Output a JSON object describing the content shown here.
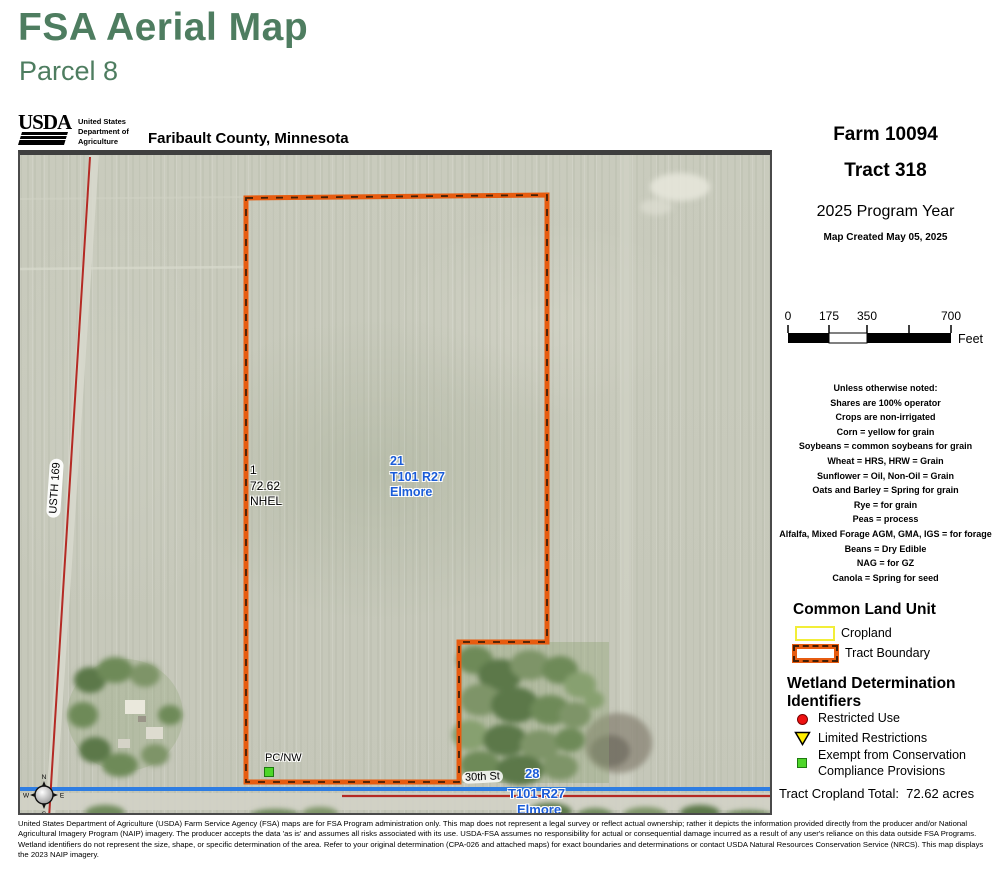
{
  "header": {
    "title": "FSA Aerial Map",
    "subtitle": "Parcel 8",
    "usda_wordmark": "USDA",
    "agency_line1": "United States",
    "agency_line2": "Department of",
    "agency_line3": "Agriculture",
    "county": "Faribault County, Minnesota"
  },
  "panel": {
    "farm": "Farm 10094",
    "tract": "Tract 318",
    "program_year": "2025 Program Year",
    "created": "Map Created May 05, 2025",
    "scale": {
      "t0": "0",
      "t175": "175",
      "t350": "350",
      "t700": "700",
      "unit": "Feet"
    },
    "notes": [
      "Unless otherwise noted:",
      "Shares are 100% operator",
      "Crops are non-irrigated",
      "Corn = yellow for grain",
      "Soybeans = common soybeans for grain",
      "Wheat = HRS, HRW = Grain",
      "Sunflower = Oil, Non-Oil = Grain",
      "Oats and Barley = Spring for grain",
      "Rye = for grain",
      "Peas = process",
      "Alfalfa, Mixed Forage AGM, GMA, IGS = for forage",
      "Beans = Dry Edible",
      "NAG = for GZ",
      "Canola = Spring for seed"
    ],
    "legend": {
      "clu_title": "Common Land Unit",
      "cropland": "Cropland",
      "tract_boundary": "Tract Boundary",
      "wetland_title_1": "Wetland Determination",
      "wetland_title_2": "Identifiers",
      "restricted": "Restricted Use",
      "limited": "Limited Restrictions",
      "exempt_1": "Exempt from Conservation",
      "exempt_2": "Compliance Provisions"
    },
    "tract_total": "Tract Cropland Total:  72.62 acres"
  },
  "map": {
    "labels": {
      "highway": "USTH 169",
      "field_number": "1",
      "field_acres": "72.62",
      "field_hel": "NHEL",
      "sec21_num": "21",
      "sec21_twp": "T101 R27",
      "sec21_name": "Elmore",
      "wetland_pcnw": "PC/NW",
      "street": "30th St",
      "sec28_num": "28",
      "sec28_twp": "T101 R27",
      "sec28_name": "Elmore"
    },
    "compass": {
      "n": "N",
      "e": "E",
      "s": "S",
      "w": "W"
    },
    "colors": {
      "tract_boundary": "#e75c10",
      "cropland_outline": "#f2ee38",
      "waterline_blue": "#2e7de2",
      "road_red": "#b42a24",
      "section_label_blue": "#1a5cd8",
      "marker_green": "#4ed629",
      "restricted_red": "#ee1111",
      "limited_yellow": "#ffee00"
    }
  },
  "footer": {
    "disclaimer": "United States Department of Agriculture (USDA) Farm Service Agency (FSA) maps are for FSA Program administration only.  This map does not represent a legal survey or reflect actual ownership; rather it depicts the information provided directly from the producer and/or National Agricultural Imagery Program (NAIP) imagery.  The producer accepts the data 'as is' and assumes all risks associated with its use.  USDA-FSA assumes no responsibility for actual or consequential damage incurred as a result of any user's reliance on this data outside FSA Programs.  Wetland identifiers do not represent the size, shape, or specific determination of the area.  Refer to your original determination (CPA-026 and attached maps) for exact boundaries and determinations or contact USDA Natural Resources Conservation Service (NRCS).  This map displays the 2023 NAIP imagery."
  }
}
